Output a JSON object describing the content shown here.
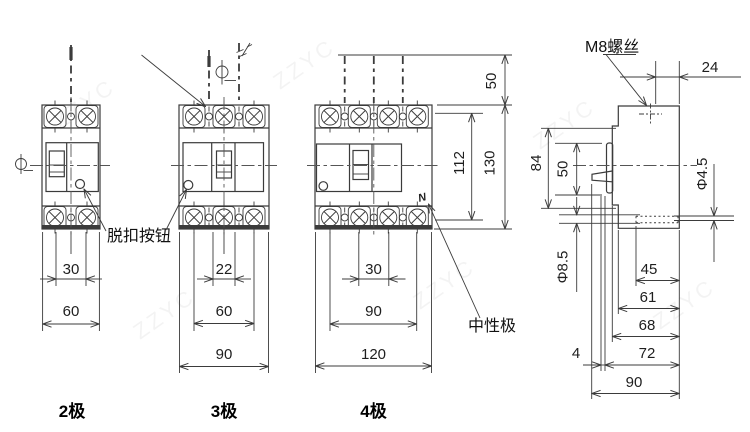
{
  "labels": {
    "trip_button": "脱扣按钮",
    "neutral_pole": "中性极",
    "m8_screw": "M8螺丝",
    "neutral_mark": "N"
  },
  "captions": {
    "p2": "2极",
    "p3": "3极",
    "p4": "4极"
  },
  "front_dims": {
    "p2": {
      "pole_spacing": "30",
      "width": "60"
    },
    "p3": {
      "center_width": "22",
      "pole_span": "60",
      "width": "90"
    },
    "p4": {
      "pole_spacing": "30",
      "pole_span": "90",
      "width": "120"
    }
  },
  "height_dims": {
    "wire_strip": "50",
    "terminal_span": "112",
    "overall": "130"
  },
  "side_dims": {
    "top_depth": "24",
    "body_height": "84",
    "handle_height": "50",
    "front_hole": "Φ4.5",
    "back_hole": "Φ8.5",
    "depth_45": "45",
    "depth_61": "61",
    "depth_68": "68",
    "depth_72": "72",
    "offset_4": "4",
    "depth_90": "90"
  },
  "watermark": "ZZYC"
}
